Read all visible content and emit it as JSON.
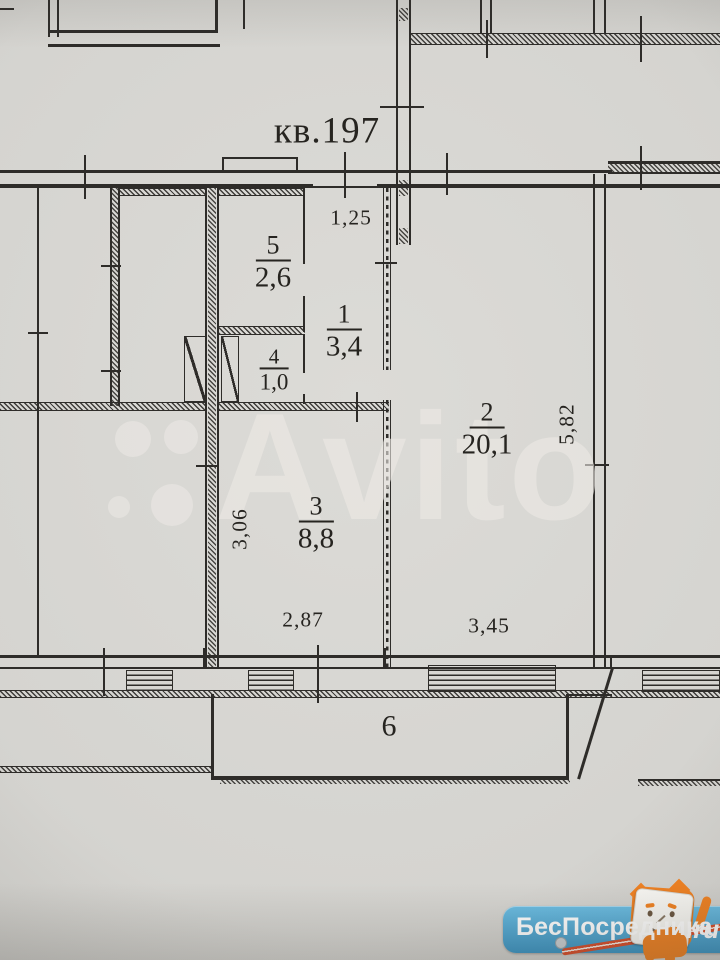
{
  "plan": {
    "apartment_label": "кв.197",
    "rooms": {
      "r5": {
        "number": "5",
        "area": "2,6"
      },
      "r1": {
        "number": "1",
        "area": "3,4"
      },
      "r4": {
        "number": "4",
        "area": "1,0"
      },
      "r2": {
        "number": "2",
        "area": "20,1"
      },
      "r3": {
        "number": "3",
        "area": "8,8"
      },
      "r6": {
        "number": "6"
      }
    },
    "dimensions": {
      "hall_width": "1,25",
      "kitchen_depth": "3,06",
      "kitchen_width": "2,87",
      "living_width": "3,45",
      "living_depth": "5,82"
    }
  },
  "watermark": {
    "text": "Avito"
  },
  "branding": {
    "site_name": "БесПосредника",
    "tld": ".ru"
  },
  "colors": {
    "paper": "#d7d6d2",
    "ink": "#2e2c29",
    "brand_blue": "#46a4d4",
    "brand_orange": "#f08223",
    "pencil_red": "#d94e2a",
    "watermark": "#eceae5"
  }
}
